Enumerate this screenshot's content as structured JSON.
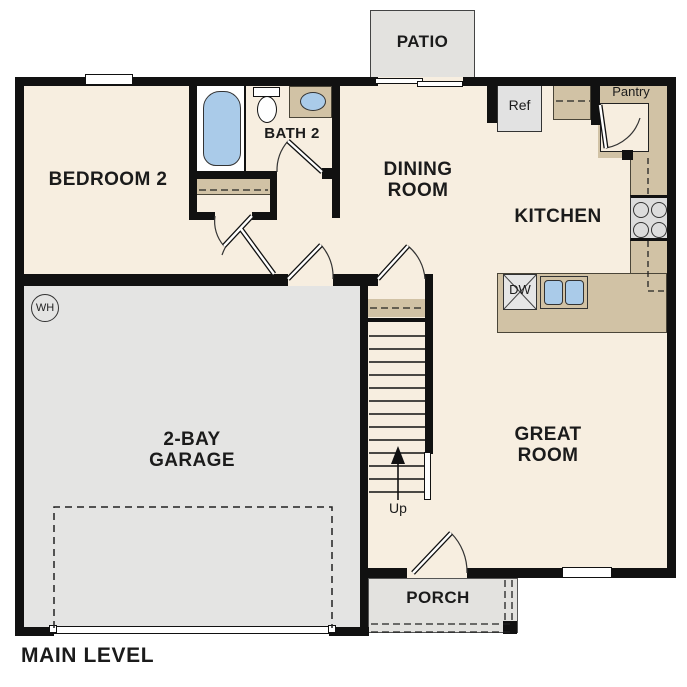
{
  "title": "MAIN LEVEL",
  "labels": {
    "patio": "PATIO",
    "bedroom2": "BEDROOM 2",
    "bath2": "BATH 2",
    "dining_line1": "DINING",
    "dining_line2": "ROOM",
    "kitchen": "KITCHEN",
    "great_line1": "GREAT",
    "great_line2": "ROOM",
    "garage_line1": "2-BAY",
    "garage_line2": "GARAGE",
    "porch": "PORCH",
    "ref": "Ref",
    "pantry": "Pantry",
    "dw": "DW",
    "up": "Up",
    "wh": "WH"
  },
  "colors": {
    "floor_cream": "#f7eee0",
    "garage_gray": "#e4e4e3",
    "patio_gray": "#e3e2df",
    "counter_tan": "#d1c2a5",
    "fixture_blue": "#aacbe9",
    "appliance_gray": "#e2e2e2",
    "wall_black": "#111111"
  }
}
